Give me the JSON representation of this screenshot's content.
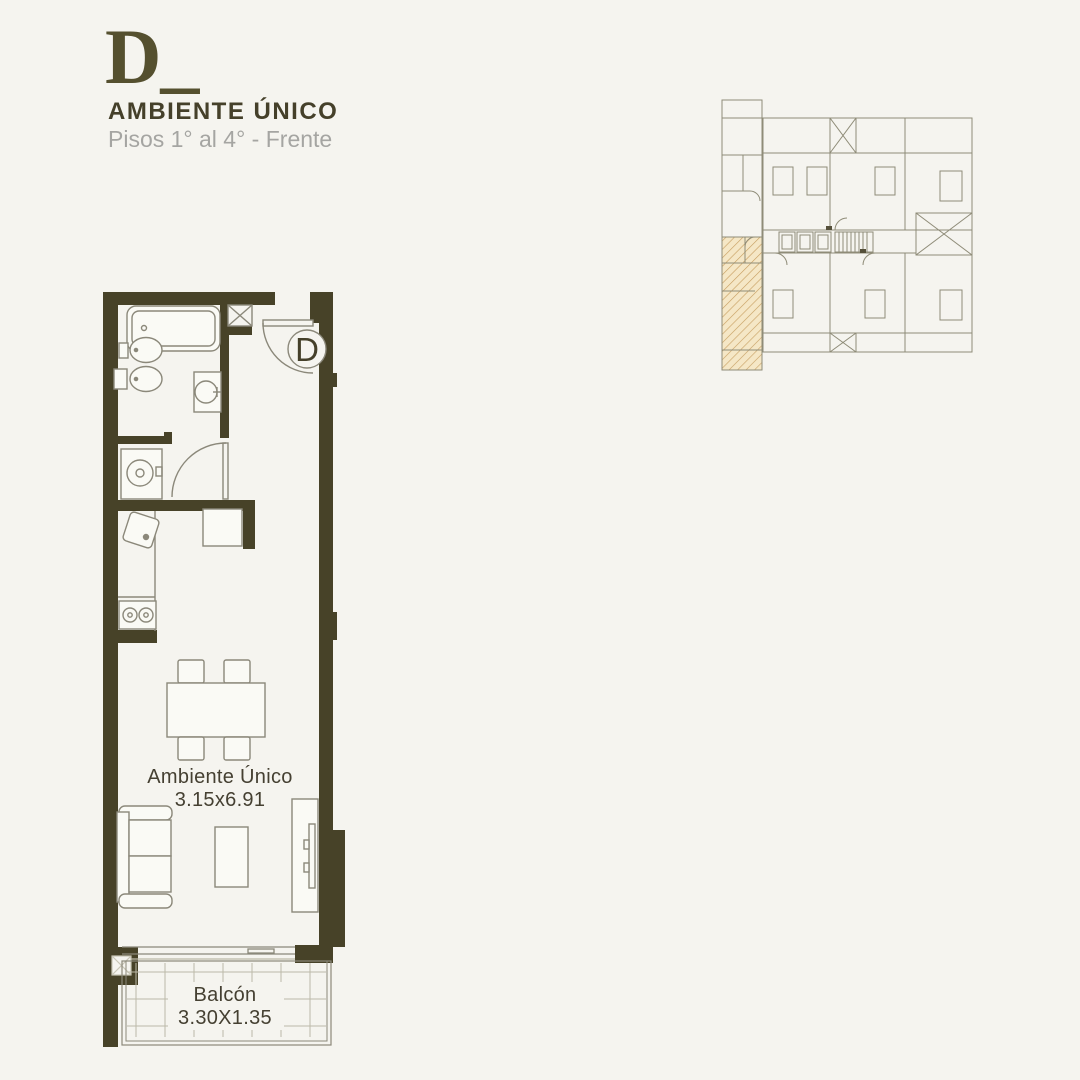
{
  "header": {
    "plan_letter": "D_",
    "title": "AMBIENTE ÚNICO",
    "subtitle": "Pisos 1° al 4° - Frente"
  },
  "floor_plan": {
    "entry_label": "D",
    "main_room": {
      "name": "Ambiente Único",
      "dimensions": "3.15x6.91"
    },
    "balcony": {
      "name": "Balcón",
      "dimensions": "3.30X1.35"
    }
  },
  "key_plan": {
    "highlighted_unit": "D",
    "highlight_fill": "#f5e7c6",
    "hatch_color": "#c79e60"
  },
  "colors": {
    "background": "#f5f4ef",
    "wall": "#474228",
    "furniture_line": "#8b887a",
    "grid_line": "#bcb9a8",
    "text_dark": "#454032",
    "subtitle_gray": "#a5a5a2",
    "brand_olive": "#55502f"
  }
}
